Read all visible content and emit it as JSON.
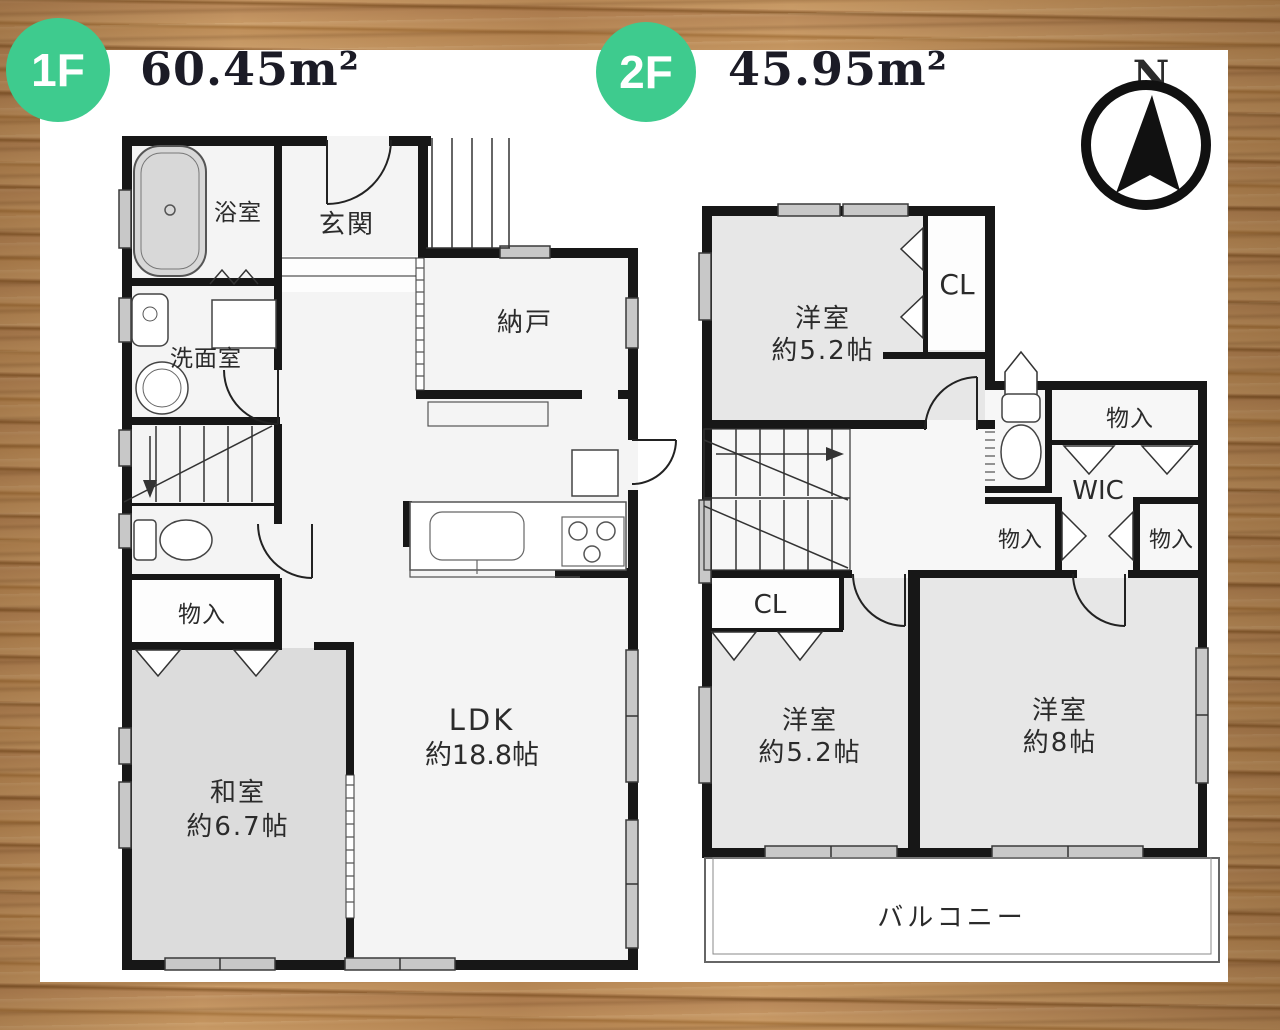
{
  "badges": {
    "floor1": "1F",
    "floor2": "2F"
  },
  "areas": {
    "floor1": "60.45m²",
    "floor2": "45.95m²"
  },
  "compass": {
    "north": "N"
  },
  "colors": {
    "badge_green": "#3ecb8e",
    "wood": "#b9895a",
    "wall": "#171717",
    "room_gray": "#e7e7e7",
    "tatami_gray": "#dcdcdc"
  },
  "floor1": {
    "bathroom": "浴室",
    "washroom": "洗面室",
    "entrance": "玄関",
    "storage_room": "納戸",
    "closet": "物入",
    "japanese_room": {
      "name": "和室",
      "size": "約6.7帖"
    },
    "ldk": {
      "name": "LDK",
      "size": "約18.8帖"
    }
  },
  "floor2": {
    "bedroom_north": {
      "name": "洋室",
      "size": "約5.2帖"
    },
    "closet_north": "CL",
    "storage_top": "物入",
    "wic": "WIC",
    "storage_left": "物入",
    "storage_right": "物入",
    "closet_south": "CL",
    "bedroom_southwest": {
      "name": "洋室",
      "size": "約5.2帖"
    },
    "bedroom_southeast": {
      "name": "洋室",
      "size": "約8帖"
    },
    "balcony": "バルコニー"
  }
}
